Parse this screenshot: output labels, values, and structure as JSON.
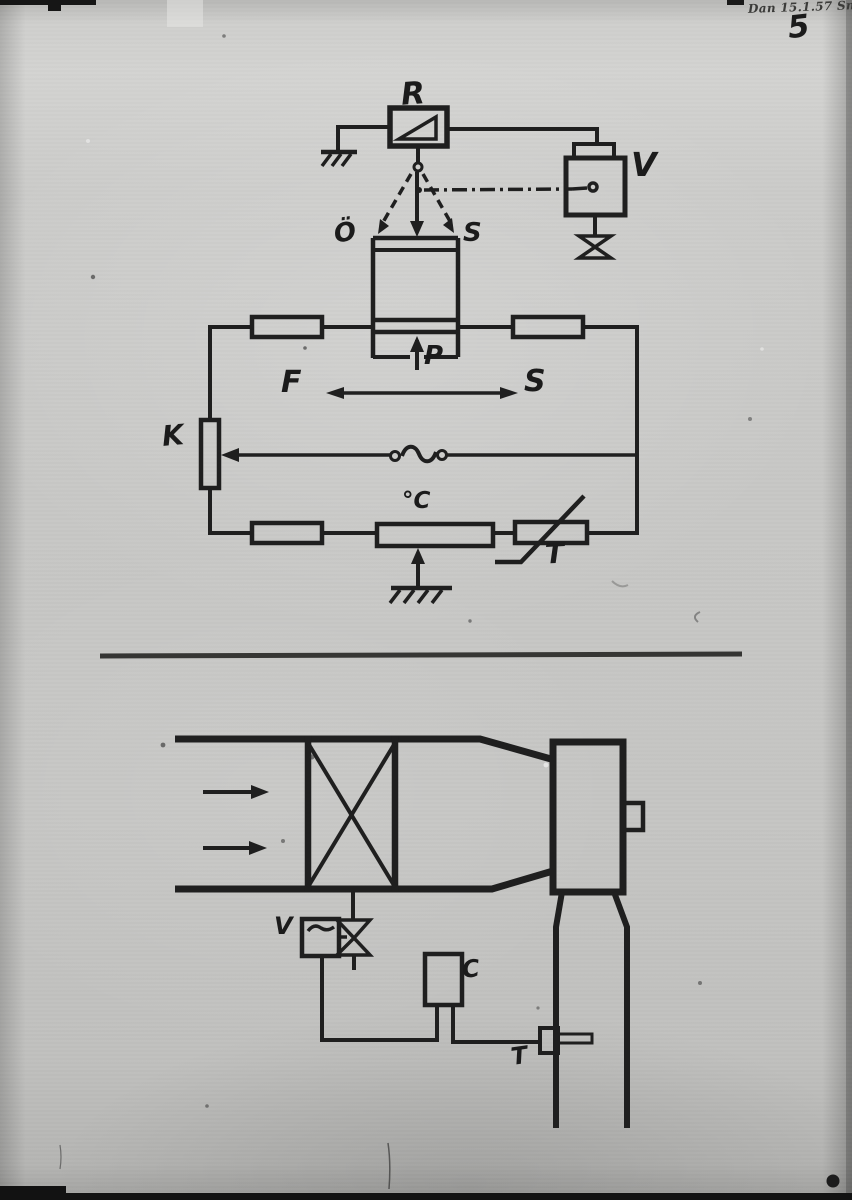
{
  "photo": {
    "handwritten_annotation": "Dan 15.1.57 Sm",
    "page_number": "5"
  },
  "control_schematic": {
    "labels": {
      "regulator": "R",
      "valve_actuator": "V",
      "open": "Ö",
      "closed": "S",
      "pressure": "P",
      "forward": "F",
      "supply": "S",
      "compensator": "K",
      "setpoint": "°C",
      "thermistor": "T"
    }
  },
  "plant_diagram": {
    "labels": {
      "valve": "V",
      "controller": "C",
      "sensor": "T"
    }
  },
  "colors": {
    "ink": "#1f1f1f",
    "paper": "#c7c7c5"
  }
}
